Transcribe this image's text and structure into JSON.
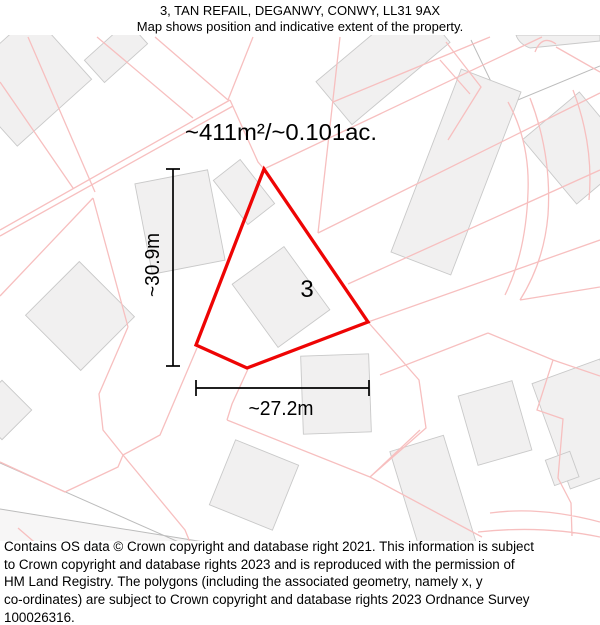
{
  "header": {
    "title": "3, TAN REFAIL, DEGANWY, CONWY, LL31 9AX",
    "subtitle": "Map shows position and indicative extent of the property."
  },
  "map": {
    "area_label": "~411m²/~0.101ac.",
    "plot_number": "3",
    "height_label": "~30.9m",
    "width_label": "~27.2m",
    "colors": {
      "boundary_red": "#ee0404",
      "parcel_pink": "#f7bfbf",
      "building_fill": "#f1f0f0",
      "building_stroke": "#c9c9c9",
      "road_gray": "#bcbcbc",
      "label_black": "#000000"
    }
  },
  "footer": {
    "lines": [
      "Contains OS data © Crown copyright and database right 2021. This information is subject",
      "to Crown copyright and database rights 2023 and is reproduced with the permission of",
      "HM Land Registry. The polygons (including the associated geometry, namely x, y",
      "co-ordinates) are subject to Crown copyright and database rights 2023 Ordnance Survey",
      "100026316."
    ]
  }
}
